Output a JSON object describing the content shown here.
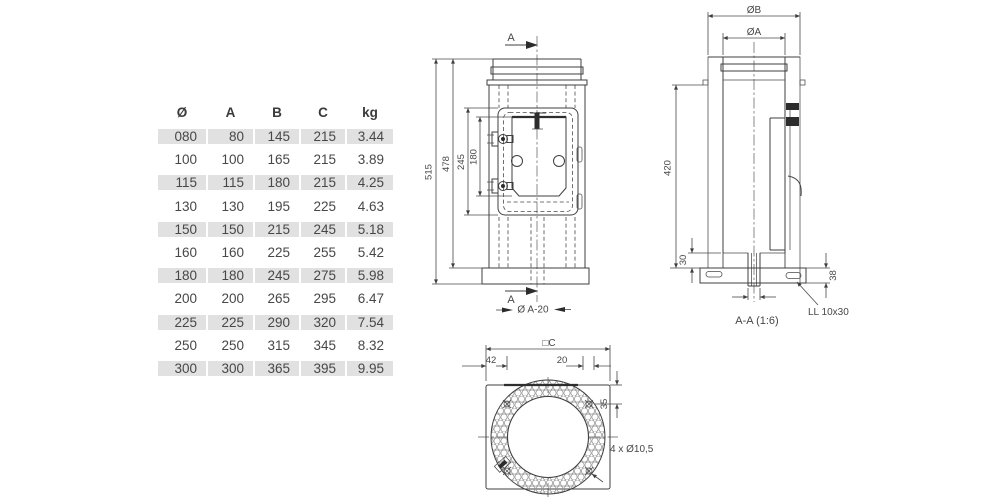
{
  "table": {
    "headers": [
      "Ø",
      "A",
      "B",
      "C",
      "kg"
    ],
    "rows": [
      [
        "080",
        "80",
        "145",
        "215",
        "3.44"
      ],
      [
        "100",
        "100",
        "165",
        "215",
        "3.89"
      ],
      [
        "115",
        "115",
        "180",
        "215",
        "4.25"
      ],
      [
        "130",
        "130",
        "195",
        "225",
        "4.63"
      ],
      [
        "150",
        "150",
        "215",
        "245",
        "5.18"
      ],
      [
        "160",
        "160",
        "225",
        "255",
        "5.42"
      ],
      [
        "180",
        "180",
        "245",
        "275",
        "5.98"
      ],
      [
        "200",
        "200",
        "265",
        "295",
        "6.47"
      ],
      [
        "225",
        "225",
        "290",
        "320",
        "7.54"
      ],
      [
        "250",
        "250",
        "315",
        "345",
        "8.32"
      ],
      [
        "300",
        "300",
        "365",
        "395",
        "9.95"
      ]
    ],
    "shade_color": "#e1e1e1"
  },
  "front_view": {
    "section_label_top": "A",
    "section_label_bottom": "A",
    "dims": {
      "total_height": "515",
      "body_height": "478",
      "door_frame_height": "245",
      "door_inner_height": "180",
      "drain_dia": "Ø A-20"
    }
  },
  "section_view": {
    "dims": {
      "outer_dia": "ØB",
      "inner_dia": "ØA",
      "height": "420",
      "insulation_bottom": "30",
      "base_plate": "38"
    },
    "caption": "A-A (1:6)",
    "slot_label": "LL 10x30"
  },
  "top_view": {
    "dims": {
      "square_width": "□C",
      "left_offset": "42",
      "edge_offset": "20",
      "top_offset": "35"
    },
    "holes_label": "4 x Ø10,5"
  },
  "colors": {
    "line": "#3f3f3f",
    "shade": "#e1e1e1",
    "text": "#474747"
  }
}
